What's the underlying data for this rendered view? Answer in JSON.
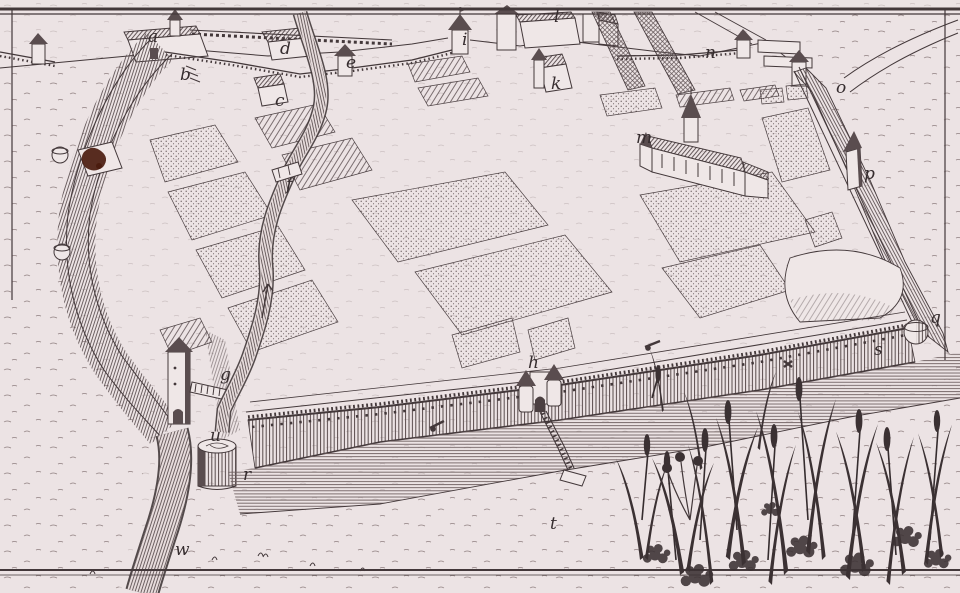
{
  "figure": {
    "kind": "engraved-birds-eye-plan-of-walled-enclosure",
    "paper_color": "#ece3e3",
    "ink_color": "#43383a",
    "stain_color": "#4b1c0f",
    "water_line_color": "#6e5f60"
  },
  "labels": [
    {
      "char": "a",
      "x": 148,
      "y": 42
    },
    {
      "char": "b",
      "x": 180,
      "y": 80
    },
    {
      "char": "c",
      "x": 275,
      "y": 106
    },
    {
      "char": "d",
      "x": 280,
      "y": 54
    },
    {
      "char": "e",
      "x": 346,
      "y": 68
    },
    {
      "char": "f",
      "x": 286,
      "y": 190
    },
    {
      "char": "g",
      "x": 220,
      "y": 380
    },
    {
      "char": "h",
      "x": 528,
      "y": 368
    },
    {
      "char": "i",
      "x": 462,
      "y": 45
    },
    {
      "char": "k",
      "x": 551,
      "y": 89
    },
    {
      "char": "l",
      "x": 554,
      "y": 22
    },
    {
      "char": "m",
      "x": 636,
      "y": 143
    },
    {
      "char": "n",
      "x": 705,
      "y": 58
    },
    {
      "char": "o",
      "x": 836,
      "y": 93
    },
    {
      "char": "p",
      "x": 864,
      "y": 179
    },
    {
      "char": "q",
      "x": 930,
      "y": 323
    },
    {
      "char": "r",
      "x": 243,
      "y": 480
    },
    {
      "char": "s",
      "x": 874,
      "y": 355
    },
    {
      "char": "t",
      "x": 550,
      "y": 529
    },
    {
      "char": "u",
      "x": 210,
      "y": 441
    },
    {
      "char": "w",
      "x": 175,
      "y": 555
    }
  ]
}
